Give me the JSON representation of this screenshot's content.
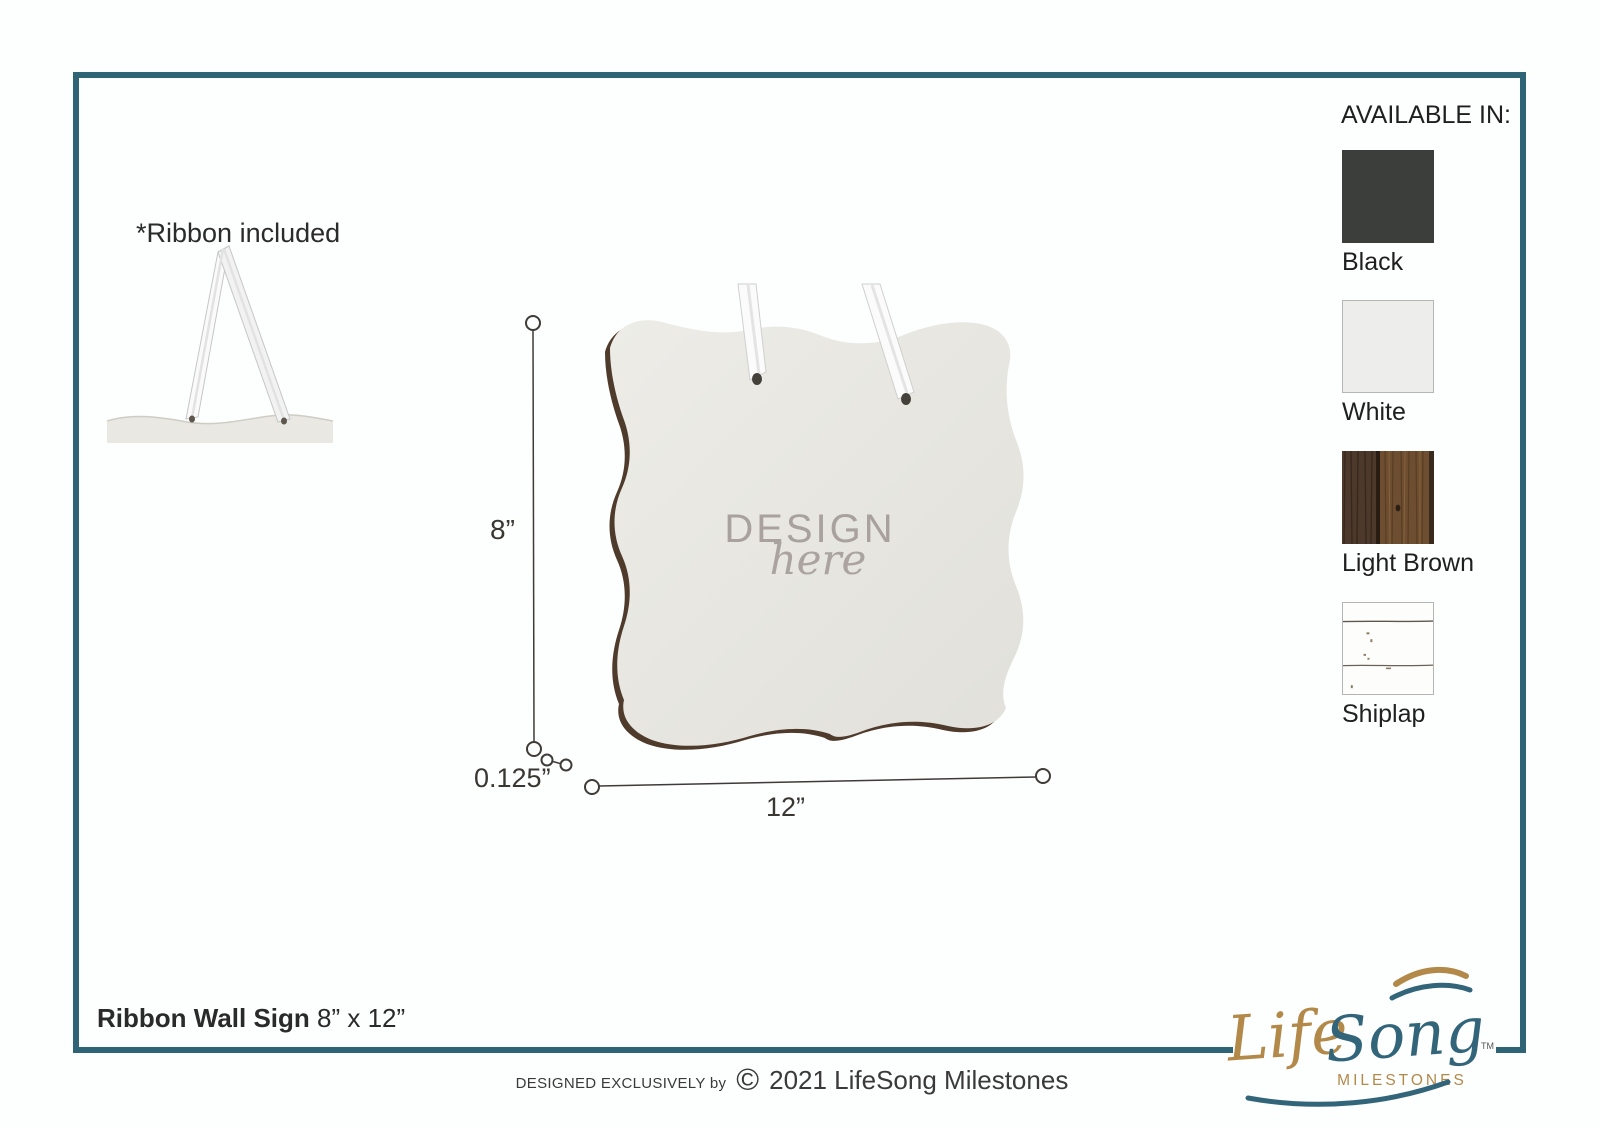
{
  "page": {
    "frame_color": "#2e6476",
    "background": "#fdfefe"
  },
  "ribbon_note": {
    "label": "*Ribbon included"
  },
  "available_in": {
    "title": "AVAILABLE IN:",
    "options": [
      {
        "label": "Black",
        "type": "solid",
        "color": "#3b3e3b"
      },
      {
        "label": "White",
        "type": "solid",
        "color": "#ededec"
      },
      {
        "label": "Light Brown",
        "type": "wood"
      },
      {
        "label": "Shiplap",
        "type": "shiplap"
      }
    ]
  },
  "sign": {
    "design_word": "DESIGN",
    "design_script": "here"
  },
  "dimensions": {
    "height": "8”",
    "thickness": "0.125”",
    "width": "12”"
  },
  "product": {
    "name": "Ribbon Wall Sign",
    "size": "8” x 12”"
  },
  "credit": {
    "prefix": "DESIGNED EXCLUSIVELY by",
    "symbol": "©",
    "text": "2021 LifeSong Milestones"
  },
  "logo": {
    "life": "Life",
    "song": "Song",
    "sub": "MILESTONES",
    "tm": "TM"
  }
}
